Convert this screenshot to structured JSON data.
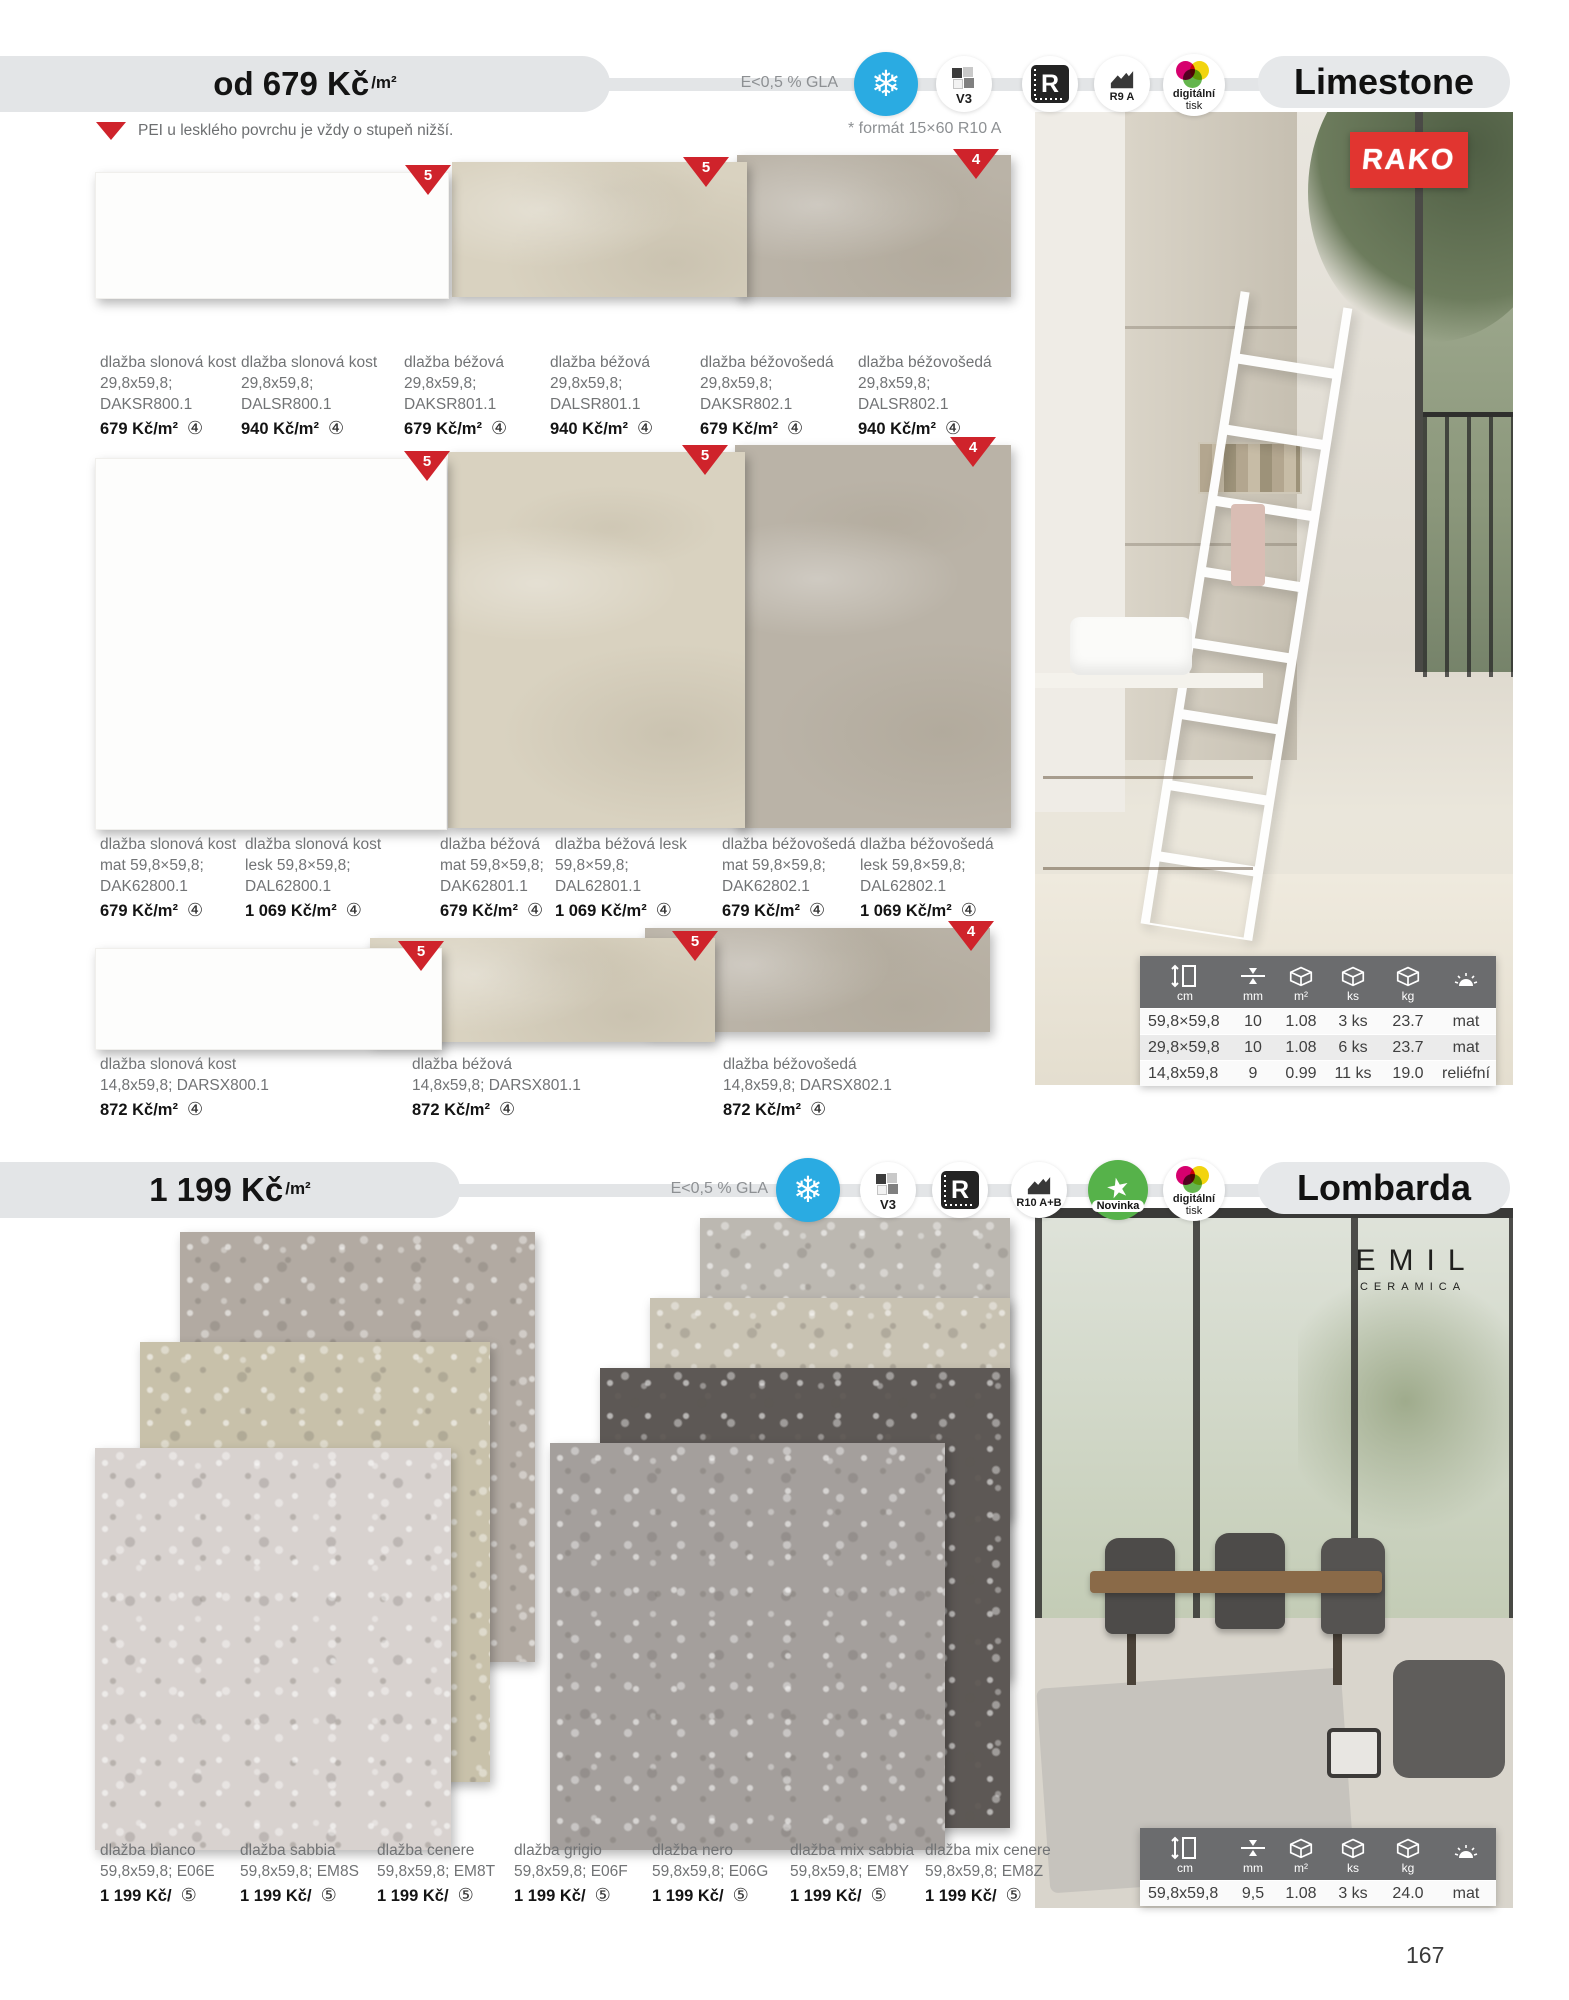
{
  "page": {
    "number": "167"
  },
  "colors": {
    "accent_red": "#cf232b",
    "frost_blue": "#2aabe2",
    "novinka_green": "#56b24a",
    "rako_red": "#e13530",
    "header_grey": "#e3e5e7"
  },
  "limestone": {
    "price": "od 679 Kč",
    "price_unit": "/m²",
    "emission": "E<0,5 % GLA",
    "format_note": "* formát 15×60 R10 A",
    "pei_note": "PEI u lesklého povrchu je vždy o stupeň nižší.",
    "title": "Limestone",
    "brand": "RAKO",
    "icon_labels": {
      "v3": "V3",
      "r": "R",
      "slip": "R9 A",
      "print_line1": "digitální",
      "print_line2": "tisk"
    },
    "badges_row1": [
      "5",
      "5",
      "4"
    ],
    "badges_row2": [
      "5",
      "5",
      "4"
    ],
    "badges_row3": [
      "5",
      "5",
      "4"
    ],
    "swatch_colors": {
      "ivory": "#fdfdfc",
      "beige": "#d9d2c0",
      "beige_grey": "#bab3a7"
    },
    "row1": [
      {
        "name": "dlažba slonová kost",
        "size": "29,8x59,8;",
        "code": "DAKSR800.1",
        "price": "679 Kč/m²",
        "note": "④"
      },
      {
        "name": "dlažba slonová kost",
        "size": "29,8x59,8;",
        "code": "DALSR800.1",
        "price": "940 Kč/m²",
        "note": "④"
      },
      {
        "name": "dlažba béžová",
        "size": "29,8x59,8;",
        "code": "DAKSR801.1",
        "price": "679 Kč/m²",
        "note": "④"
      },
      {
        "name": "dlažba béžová",
        "size": "29,8x59,8;",
        "code": "DALSR801.1",
        "price": "940 Kč/m²",
        "note": "④"
      },
      {
        "name": "dlažba béžovošedá",
        "size": "29,8x59,8;",
        "code": "DAKSR802.1",
        "price": "679 Kč/m²",
        "note": "④"
      },
      {
        "name": "dlažba béžovošedá",
        "size": "29,8x59,8;",
        "code": "DALSR802.1",
        "price": "940 Kč/m²",
        "note": "④"
      }
    ],
    "row2": [
      {
        "name": "dlažba slonová kost",
        "size": "mat 59,8×59,8;",
        "code": "DAK62800.1",
        "price": "679 Kč/m²",
        "note": "④"
      },
      {
        "name": "dlažba slonová kost",
        "size": "lesk 59,8×59,8;",
        "code": "DAL62800.1",
        "price": "1 069 Kč/m²",
        "note": "④"
      },
      {
        "name": "dlažba béžová",
        "size": "mat 59,8×59,8;",
        "code": "DAK62801.1",
        "price": "679 Kč/m²",
        "note": "④"
      },
      {
        "name": "dlažba béžová lesk",
        "size": "59,8×59,8;",
        "code": "DAL62801.1",
        "price": "1 069 Kč/m²",
        "note": "④"
      },
      {
        "name": "dlažba béžovošedá",
        "size": "mat 59,8×59,8;",
        "code": "DAK62802.1",
        "price": "679 Kč/m²",
        "note": "④"
      },
      {
        "name": "dlažba béžovošedá",
        "size": "lesk 59,8×59,8;",
        "code": "DAL62802.1",
        "price": "1 069 Kč/m²",
        "note": "④"
      }
    ],
    "row3": [
      {
        "name": "dlažba slonová kost",
        "info": "14,8x59,8; DARSX800.1",
        "price": "872 Kč/m²",
        "note": "④"
      },
      {
        "name": "dlažba béžová",
        "info": "14,8x59,8; DARSX801.1",
        "price": "872 Kč/m²",
        "note": "④"
      },
      {
        "name": "dlažba béžovošedá",
        "info": "14,8x59,8; DARSX802.1",
        "price": "872 Kč/m²",
        "note": "④"
      }
    ],
    "table": {
      "headers": [
        "cm",
        "mm",
        "m²",
        "ks",
        "kg",
        ""
      ],
      "rows": [
        [
          "59,8×59,8",
          "10",
          "1.08",
          "3 ks",
          "23.7",
          "mat"
        ],
        [
          "29,8×59,8",
          "10",
          "1.08",
          "6 ks",
          "23.7",
          "mat"
        ],
        [
          "14,8x59,8",
          "9",
          "0.99",
          "11 ks",
          "19.0",
          "reliéfní"
        ]
      ]
    }
  },
  "lombarda": {
    "price": "1 199 Kč",
    "price_unit": "/m²",
    "emission": "E<0,5 % GLA",
    "title": "Lombarda",
    "brand_line1": "EMIL",
    "brand_line2": "CERAMICA",
    "icon_labels": {
      "v3": "V3",
      "r": "R",
      "slip": "R10 A+B",
      "new": "Novinka",
      "print_line1": "digitální",
      "print_line2": "tisk"
    },
    "swatch_colors": {
      "bianco": "#d8d2cf",
      "sabbia": "#c8c1aa",
      "cenere": "#b2aaa2",
      "grigio": "#a49f9c",
      "nero": "#5d5855",
      "mix_sabbia": "#c8c2b2",
      "mix_cenere": "#bcb8b1"
    },
    "products": [
      {
        "name": "dlažba bianco",
        "info": "59,8x59,8; E06E",
        "price": "1 199 Kč/",
        "note": "⑤"
      },
      {
        "name": "dlažba sabbia",
        "info": "59,8x59,8; EM8S",
        "price": "1 199 Kč/",
        "note": "⑤"
      },
      {
        "name": "dlažba cenere",
        "info": "59,8x59,8; EM8T",
        "price": "1 199 Kč/",
        "note": "⑤"
      },
      {
        "name": "dlažba grigio",
        "info": "59,8x59,8; E06F",
        "price": "1 199 Kč/",
        "note": "⑤"
      },
      {
        "name": "dlažba nero",
        "info": "59,8x59,8; E06G",
        "price": "1 199 Kč/",
        "note": "⑤"
      },
      {
        "name": "dlažba mix sabbia",
        "info": "59,8x59,8; EM8Y",
        "price": "1 199 Kč/",
        "note": "⑤"
      },
      {
        "name": "dlažba mix cenere",
        "info": "59,8x59,8; EM8Z",
        "price": "1 199 Kč/",
        "note": "⑤"
      }
    ],
    "table": {
      "headers": [
        "cm",
        "mm",
        "m²",
        "ks",
        "kg",
        ""
      ],
      "rows": [
        [
          "59,8x59,8",
          "9,5",
          "1.08",
          "3 ks",
          "24.0",
          "mat"
        ]
      ]
    }
  }
}
